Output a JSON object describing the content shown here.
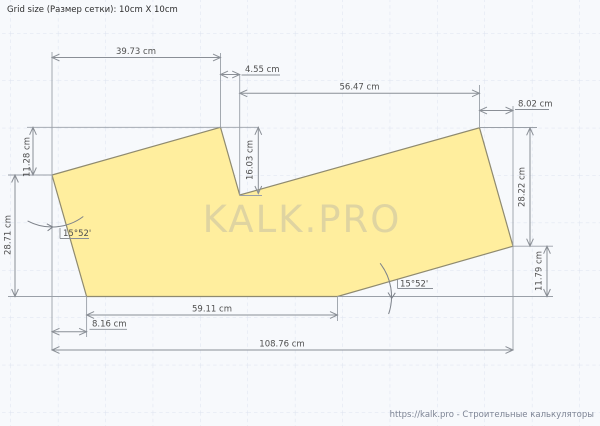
{
  "canvas": {
    "grid_info": "Grid size (Размер сетки): 10cm X 10cm",
    "watermark": "KALK.PRO",
    "credit": "https://kalk.pro - Строительные калькуляторы"
  },
  "drawing": {
    "unit": "cm",
    "grid_cell": "10cm X 10cm",
    "shape": "irregular heptagon with top notch",
    "dimensions": {
      "top_width": "39.73 cm",
      "notch_offset": "4.55 cm",
      "upper_right_width": "56.47 cm",
      "right_offset": "8.02 cm",
      "left_rise": "11.28 cm",
      "notch_depth": "16.03 cm",
      "right_height": "28.22 cm",
      "left_height": "28.71 cm",
      "right_drop": "11.79 cm",
      "bottom_width": "59.11 cm",
      "bottom_left_offset": "8.16 cm",
      "total_width": "108.76 cm"
    },
    "angles": {
      "left": "15°52'",
      "bottom": "15°52'"
    },
    "colors": {
      "shape_fill": "#ffee9e",
      "shape_stroke": "#8f8a6f",
      "dimension_stroke": "#8a8f96",
      "grid_line": "#dde3ef",
      "background": "#f7f9fc"
    }
  }
}
